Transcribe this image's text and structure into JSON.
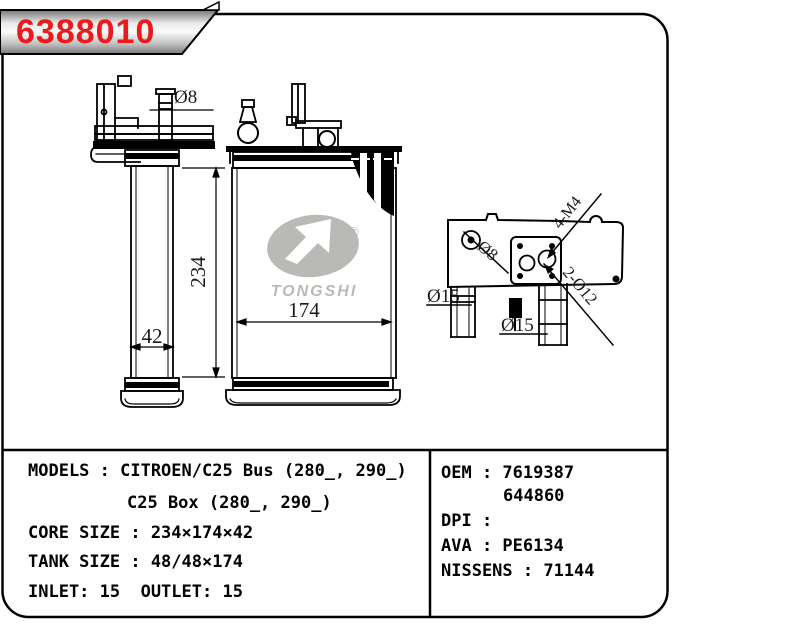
{
  "part_number": "6388010",
  "accent_color": "#ec1a1a",
  "watermark": {
    "brand": "TONGSHI",
    "registered": "®",
    "color": "#b9b9b6"
  },
  "dimensions": {
    "side_height": "234",
    "side_width": "42",
    "front_width": "174",
    "top_pipe_dia": "Ø8"
  },
  "detail_labels": {
    "screw_hole_dia": "Ø8",
    "thread": "4-M4",
    "holes": "2-Ø12",
    "left_pipe_dia": "Ø15",
    "bottom_pipe_dia": "Ø15"
  },
  "specs": {
    "left": {
      "models": "MODELS : CITROEN/C25 Bus (280_, 290_)",
      "models_cont": "C25 Box (280_, 290_)",
      "core_size": "CORE SIZE : 234×174×42",
      "tank_size": "TANK SIZE : 48/48×174",
      "inlet_outlet": "INLET: 15  OUTLET: 15"
    },
    "right": {
      "oem": "OEM : 7619387",
      "oem2": "644860",
      "dpi": "DPI :",
      "ava": "AVA : PE6134",
      "nissens": "NISSENS : 71144"
    }
  }
}
